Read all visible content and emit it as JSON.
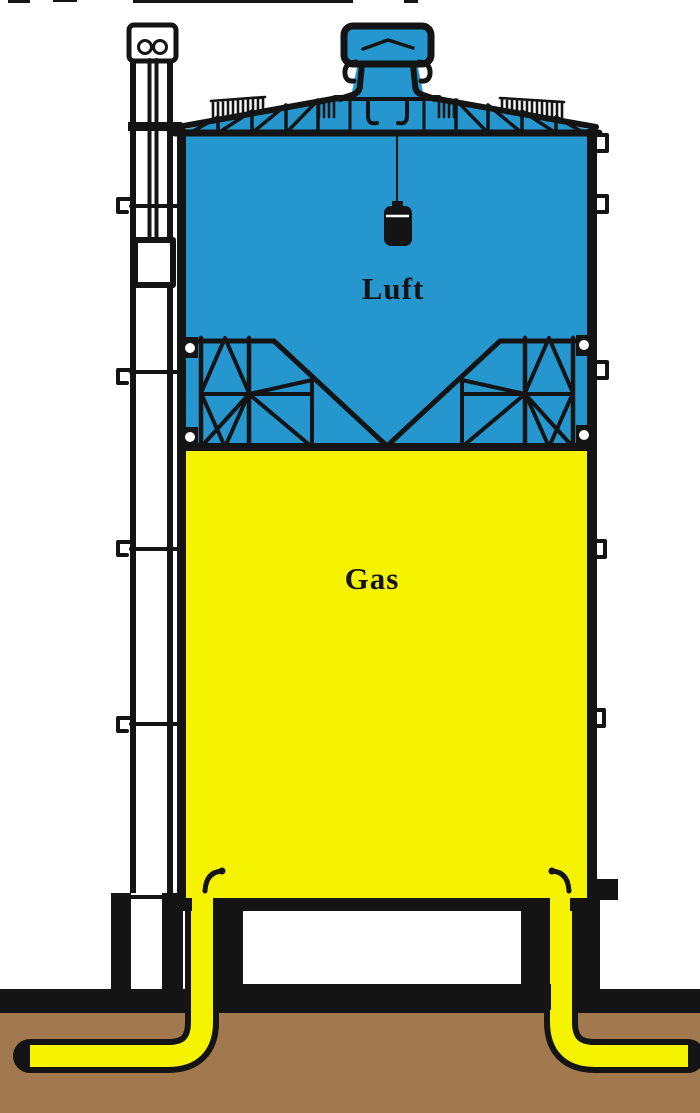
{
  "diagram": {
    "labels": {
      "air": "Luft",
      "gas": "Gas"
    },
    "colors": {
      "air": "#2596ce",
      "gas": "#f6f300",
      "earth": "#a2794f",
      "line": "#141414"
    }
  }
}
